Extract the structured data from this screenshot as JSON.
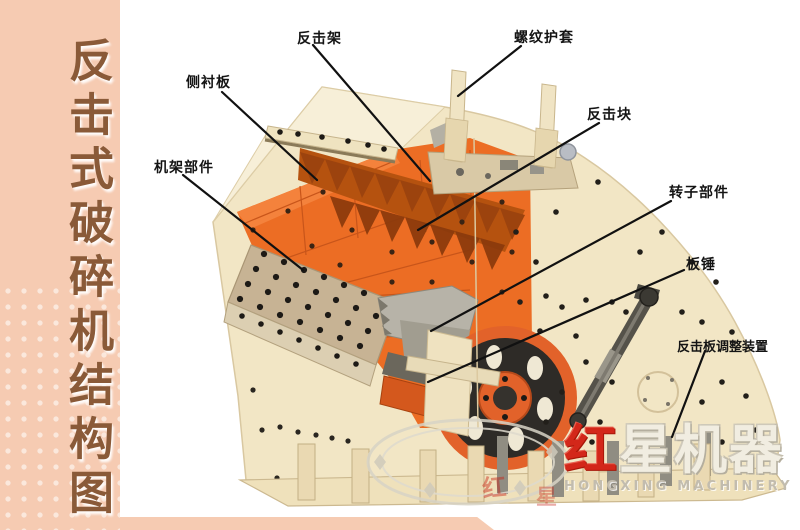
{
  "page": {
    "title": "反击式破碎机结构图"
  },
  "sidebar": {
    "title": "反击式破碎机结构图",
    "bg_color": "#f6cbb2",
    "text_color": "#8a5a38"
  },
  "diagram": {
    "labels": [
      {
        "text": "反击架"
      },
      {
        "text": "螺纹护套"
      },
      {
        "text": "侧衬板"
      },
      {
        "text": "机架部件"
      },
      {
        "text": "反击块"
      },
      {
        "text": "转子部件"
      },
      {
        "text": "板锤"
      },
      {
        "text": "反击板调整装置"
      }
    ],
    "colors": {
      "casing_cream": "#f2e6c5",
      "liner_orange": "#ec6d24",
      "impact_block_dark": "#9c430e",
      "bolt_plate_tan": "#c7b394",
      "flywheel_rim_orange": "#e2622a",
      "flywheel_dark": "#2e2b27",
      "leader_line": "#111111"
    }
  },
  "logo": {
    "cn_first": "红",
    "cn_rest": "星机器",
    "en": "HONGXING MACHINERY",
    "red": "#d3271a"
  },
  "watermark": {
    "char1": "红",
    "char2": "星"
  }
}
